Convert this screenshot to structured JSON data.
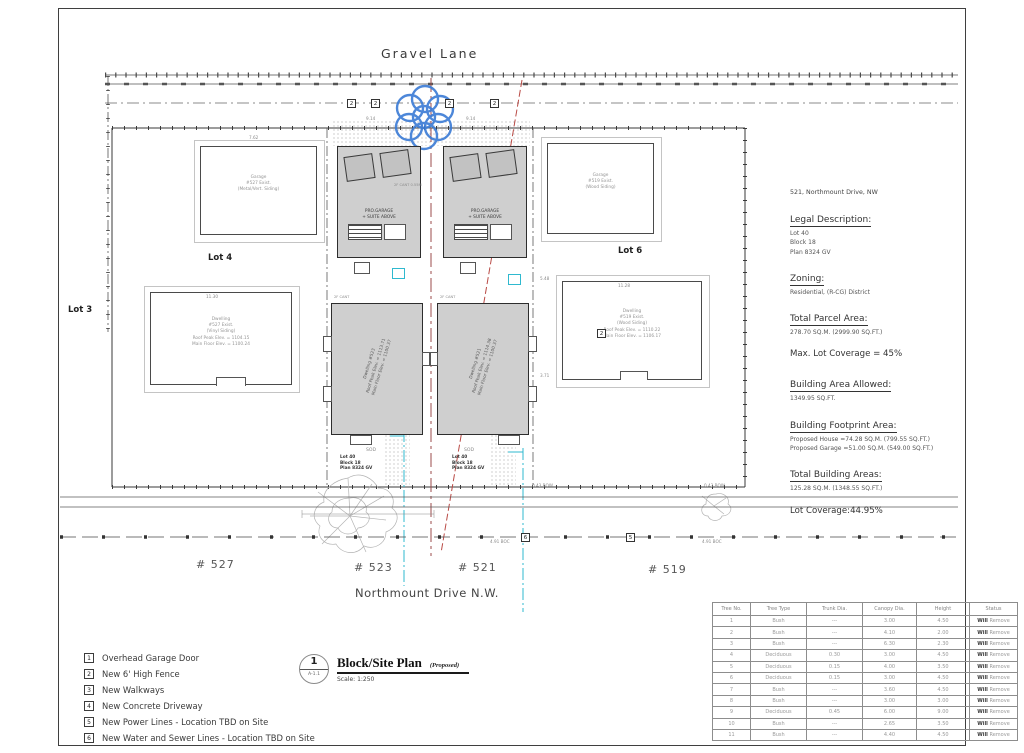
{
  "streets": {
    "top": "Gravel Lane",
    "bottom": "Northmount Drive N.W."
  },
  "lots": {
    "left": "Lot 3",
    "mid": "Lot 4",
    "right": "Lot 6"
  },
  "addresses": {
    "a527": "# 527",
    "a523": "# 523",
    "a521": "# 521",
    "a519": "# 519"
  },
  "keynotes": {
    "fence": "2",
    "power": "5",
    "sewer": "6"
  },
  "colors": {
    "tree_symbol_blue": "#3a7bd5",
    "power_line_red": "#b94a45",
    "utility_cyan": "#2fb9cf",
    "proposed_fill_gray": "#cfcfcf"
  },
  "buildings": {
    "garage_left": [
      "Garage",
      "#527 Exist.",
      "(Metal/Vert. Siding)"
    ],
    "garage_right": [
      "Garage",
      "#519 Exist.",
      "(Wood Siding)"
    ],
    "dwelling_left": [
      "Dwelling",
      "#527 Exist.",
      "(Vinyl Siding)",
      "Roof Peak Elev. = 1104.15",
      "Main Floor Elev. = 1100.24"
    ],
    "dwelling_right": [
      "Dwelling",
      "#519 Exist.",
      "(Wood Siding)",
      "Roof Peak Elev. = 1110.22",
      "Main Floor Elev. = 1106.17"
    ],
    "pro_garage": [
      "PRO.GARAGE",
      "+ SUITE ABOVE"
    ],
    "house_523": [
      "Dwelling #523",
      "Roof Peak Elev. = 1113.71",
      "Main Floor Elev. = 1100.37"
    ],
    "house_521": [
      "Dwelling #521",
      "Roof Peak Elev. = 1114.38",
      "Main Floor Elev. = 1100.37"
    ]
  },
  "yard": {
    "sod": "SOD",
    "lot_stack": [
      "Lot 40",
      "Block 18",
      "Plan 8324 GV"
    ]
  },
  "dims": {
    "w914": "9.14",
    "w762": "7.62",
    "w1130": "11.30",
    "w1128": "11.28",
    "bow": "0.43 BOW",
    "boc": "4.91 BOC",
    "d548": "5.48",
    "d371": "3.71",
    "cant": "2F CANT",
    "cantg": "2F CANT 0.55M"
  },
  "notes": {
    "address": "521, Northmount Drive, NW",
    "legal_title": "Legal Description:",
    "legal_lines": [
      "Lot    40",
      "Block  18",
      "Plan   8324 GV"
    ],
    "zoning_title": "Zoning:",
    "zoning_line": "Residential, (R-CG) District",
    "parcel_title": "Total Parcel Area:",
    "parcel_line": "278.70 SQ.M. (2999.90 SQ.FT.)",
    "max_coverage": "Max. Lot Coverage = 45%",
    "allowed_title": "Building Area Allowed:",
    "allowed_line": "1349.95 SQ.FT.",
    "footprint_title": "Building Footprint Area:",
    "footprint_lines": [
      "Proposed House  =74.28 SQ.M. (799.55 SQ.FT.)",
      "Proposed Garage =51.00 SQ.M. (549.00 SQ.FT.)"
    ],
    "total_title": "Total Building Areas:",
    "total_line": "125.28 SQ.M. (1348.55 SQ.FT.)",
    "coverage": "Lot Coverage:44.95%"
  },
  "tree_table": {
    "headers": [
      "Tree No.",
      "Tree Type",
      "Trunk Dia.",
      "Canopy Dia.",
      "Height",
      "Status"
    ],
    "rows": [
      [
        "1",
        "Bush",
        "---",
        "3.00",
        "4.50",
        "Will Remove"
      ],
      [
        "2",
        "Bush",
        "---",
        "4.10",
        "2.00",
        "Will Remove"
      ],
      [
        "3",
        "Bush",
        "---",
        "6.30",
        "2.30",
        "Will Remove"
      ],
      [
        "4",
        "Deciduous",
        "0.30",
        "3.00",
        "4.50",
        "Will Remove"
      ],
      [
        "5",
        "Deciduous",
        "0.15",
        "4.00",
        "3.50",
        "Will Remove"
      ],
      [
        "6",
        "Deciduous",
        "0.15",
        "3.00",
        "4.50",
        "Will Remove"
      ],
      [
        "7",
        "Bush",
        "---",
        "3.60",
        "4.50",
        "Will Remove"
      ],
      [
        "8",
        "Bush",
        "---",
        "3.00",
        "3.00",
        "Will Remove"
      ],
      [
        "9",
        "Deciduous",
        "0.45",
        "6.00",
        "9.00",
        "Will Remove"
      ],
      [
        "10",
        "Bush",
        "---",
        "2.65",
        "3.50",
        "Will Remove"
      ],
      [
        "11",
        "Bush",
        "---",
        "4.40",
        "4.50",
        "Will Remove"
      ]
    ]
  },
  "legend": {
    "items": [
      {
        "num": "1",
        "label": "Overhead Garage Door"
      },
      {
        "num": "2",
        "label": "New 6' High Fence"
      },
      {
        "num": "3",
        "label": "New Walkways"
      },
      {
        "num": "4",
        "label": "New Concrete Driveway"
      },
      {
        "num": "5",
        "label": "New Power Lines - Location TBD on Site"
      },
      {
        "num": "6",
        "label": "New Water and Sewer Lines - Location TBD on Site"
      }
    ]
  },
  "title_block": {
    "number": "1",
    "sheet": "A-1.1",
    "title": "Block/Site Plan",
    "suffix": "(Proposed)",
    "scale": "Scale: 1:250"
  }
}
